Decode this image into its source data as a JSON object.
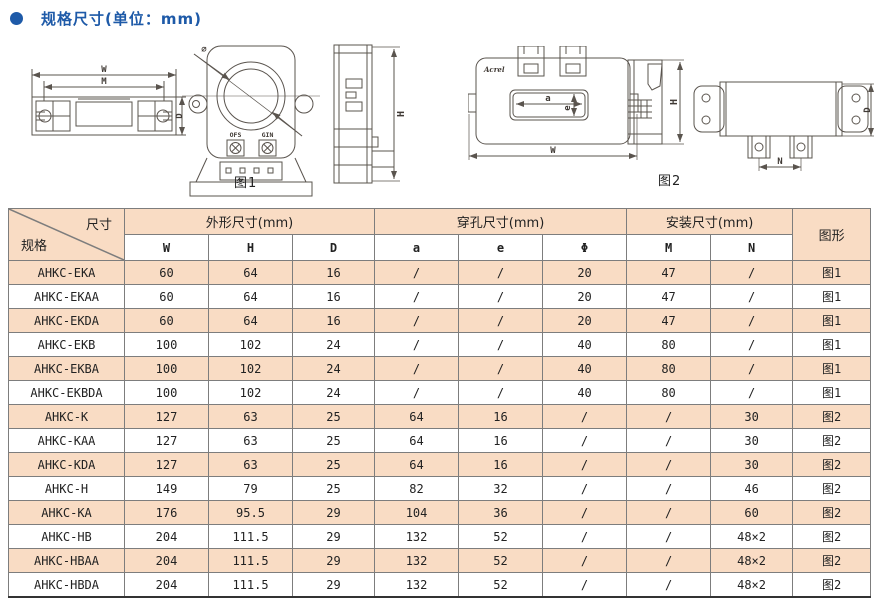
{
  "title": {
    "text": "规格尺寸(单位：mm)"
  },
  "colors": {
    "accent": "#1e5aa8",
    "row-alt": "#f9dcc4",
    "line": "#5a544e"
  },
  "figures": {
    "fig1": {
      "caption": "图1",
      "labels": {
        "W": "W",
        "M": "M",
        "D": "D",
        "H": "H",
        "phi": "∅",
        "ofs": "OFS",
        "gin": "GIN"
      }
    },
    "fig2": {
      "caption": "图2",
      "brand": "Acrel",
      "labels": {
        "a": "a",
        "e": "e",
        "W": "W",
        "H": "H",
        "D": "D",
        "N": "N"
      }
    }
  },
  "table": {
    "corner": {
      "top": "尺寸",
      "bottom": "规格"
    },
    "groups": [
      {
        "label": "外形尺寸(mm)"
      },
      {
        "label": "穿孔尺寸(mm)"
      },
      {
        "label": "安装尺寸(mm)"
      }
    ],
    "subheaders": [
      "W",
      "H",
      "D",
      "a",
      "e",
      "Φ",
      "M",
      "N"
    ],
    "figure_col": "图形",
    "rows": [
      {
        "spec": "AHKC-EKA",
        "values": [
          "60",
          "64",
          "16",
          "/",
          "/",
          "20",
          "47",
          "/",
          "图1"
        ]
      },
      {
        "spec": "AHKC-EKAA",
        "values": [
          "60",
          "64",
          "16",
          "/",
          "/",
          "20",
          "47",
          "/",
          "图1"
        ]
      },
      {
        "spec": "AHKC-EKDA",
        "values": [
          "60",
          "64",
          "16",
          "/",
          "/",
          "20",
          "47",
          "/",
          "图1"
        ]
      },
      {
        "spec": "AHKC-EKB",
        "values": [
          "100",
          "102",
          "24",
          "/",
          "/",
          "40",
          "80",
          "/",
          "图1"
        ]
      },
      {
        "spec": "AHKC-EKBA",
        "values": [
          "100",
          "102",
          "24",
          "/",
          "/",
          "40",
          "80",
          "/",
          "图1"
        ]
      },
      {
        "spec": "AHKC-EKBDA",
        "values": [
          "100",
          "102",
          "24",
          "/",
          "/",
          "40",
          "80",
          "/",
          "图1"
        ]
      },
      {
        "spec": "AHKC-K",
        "values": [
          "127",
          "63",
          "25",
          "64",
          "16",
          "/",
          "/",
          "30",
          "图2"
        ]
      },
      {
        "spec": "AHKC-KAA",
        "values": [
          "127",
          "63",
          "25",
          "64",
          "16",
          "/",
          "/",
          "30",
          "图2"
        ]
      },
      {
        "spec": "AHKC-KDA",
        "values": [
          "127",
          "63",
          "25",
          "64",
          "16",
          "/",
          "/",
          "30",
          "图2"
        ]
      },
      {
        "spec": "AHKC-H",
        "values": [
          "149",
          "79",
          "25",
          "82",
          "32",
          "/",
          "/",
          "46",
          "图2"
        ]
      },
      {
        "spec": "AHKC-KA",
        "values": [
          "176",
          "95.5",
          "29",
          "104",
          "36",
          "/",
          "/",
          "60",
          "图2"
        ]
      },
      {
        "spec": "AHKC-HB",
        "values": [
          "204",
          "111.5",
          "29",
          "132",
          "52",
          "/",
          "/",
          "48×2",
          "图2"
        ]
      },
      {
        "spec": "AHKC-HBAA",
        "values": [
          "204",
          "111.5",
          "29",
          "132",
          "52",
          "/",
          "/",
          "48×2",
          "图2"
        ]
      },
      {
        "spec": "AHKC-HBDA",
        "values": [
          "204",
          "111.5",
          "29",
          "132",
          "52",
          "/",
          "/",
          "48×2",
          "图2"
        ]
      }
    ]
  }
}
